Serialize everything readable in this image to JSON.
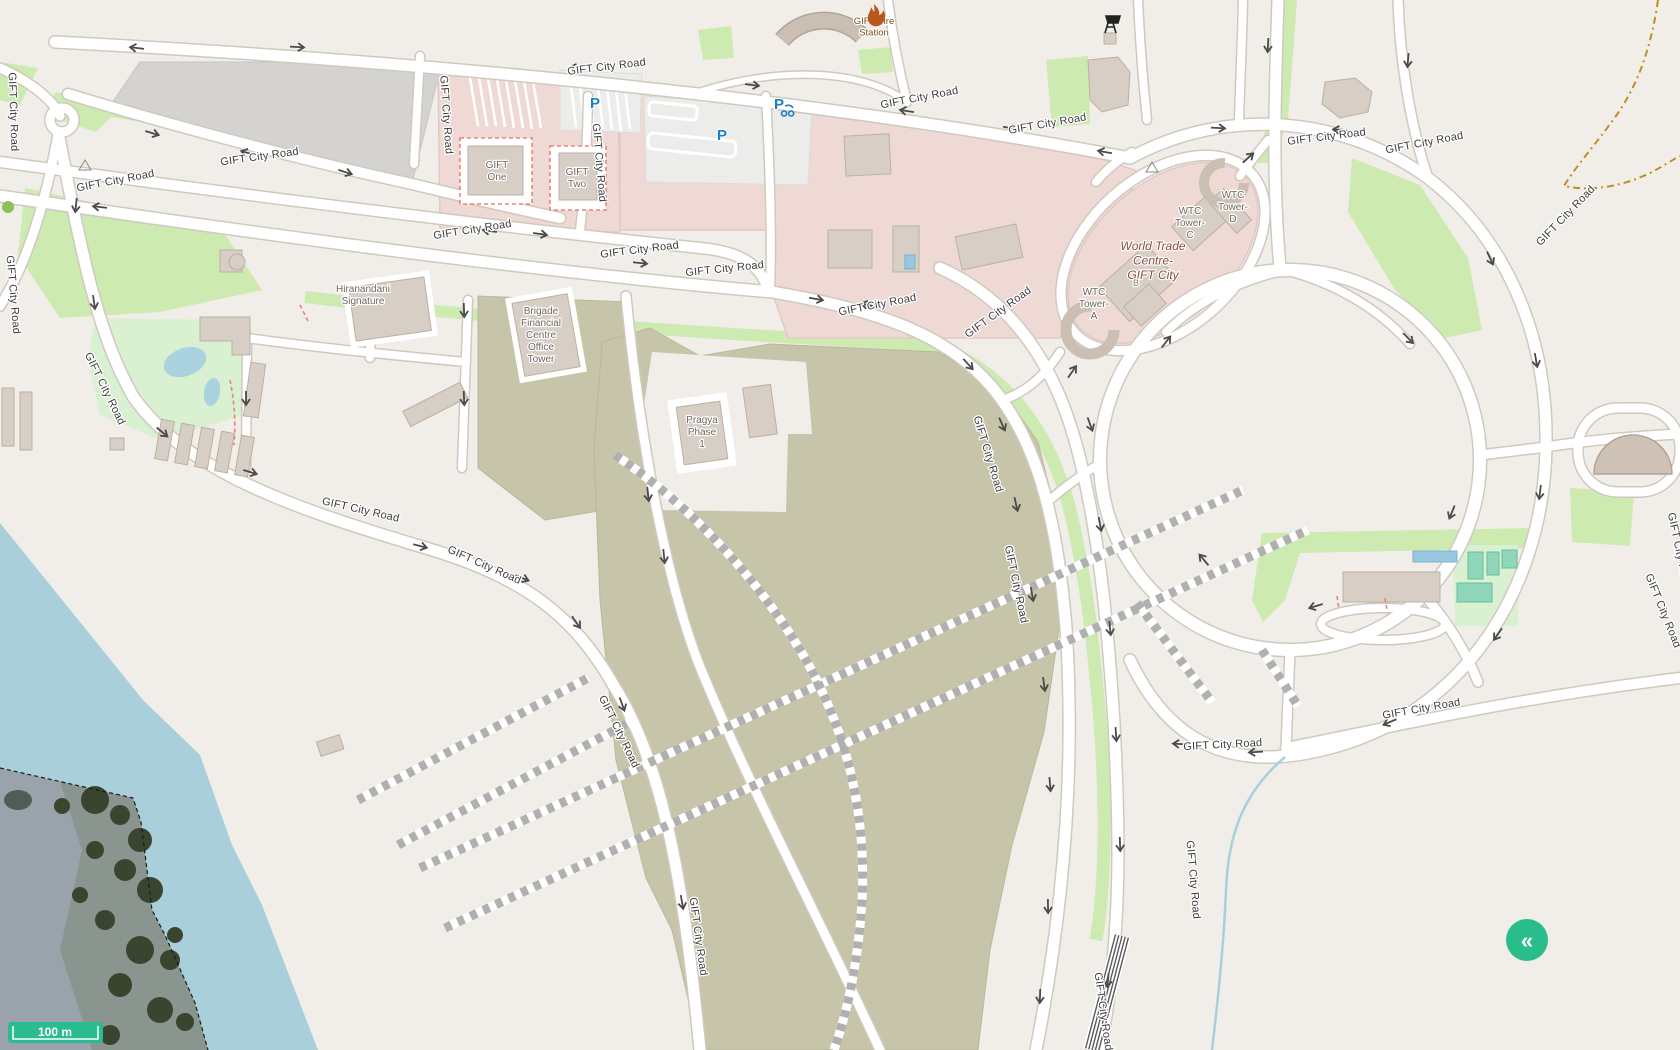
{
  "map": {
    "road_name": "GIFT City Road",
    "road_labels": [
      [
        607,
        70,
        -7
      ],
      [
        920,
        101,
        -11
      ],
      [
        1048,
        127,
        -10
      ],
      [
        260,
        160,
        -8
      ],
      [
        116,
        184,
        -11
      ],
      [
        10,
        112,
        88
      ],
      [
        10,
        295,
        85
      ],
      [
        443,
        115,
        86
      ],
      [
        596,
        163,
        85
      ],
      [
        473,
        233,
        -9
      ],
      [
        640,
        253,
        -7
      ],
      [
        725,
        272,
        -6
      ],
      [
        878,
        308,
        -11
      ],
      [
        1000,
        315,
        -36
      ],
      [
        102,
        390,
        64
      ],
      [
        360,
        513,
        13
      ],
      [
        483,
        568,
        24
      ],
      [
        616,
        733,
        64
      ],
      [
        695,
        937,
        82
      ],
      [
        1327,
        140,
        -7
      ],
      [
        1425,
        146,
        -11
      ],
      [
        1568,
        218,
        -46
      ],
      [
        985,
        455,
        73
      ],
      [
        1013,
        585,
        78
      ],
      [
        1190,
        880,
        85
      ],
      [
        1100,
        1012,
        82
      ],
      [
        1223,
        748,
        -3
      ],
      [
        1422,
        712,
        -10
      ],
      [
        1660,
        612,
        68
      ],
      [
        1676,
        552,
        78
      ]
    ],
    "arrows": [
      [
        137,
        48,
        187
      ],
      [
        297,
        47,
        3
      ],
      [
        577,
        68,
        188
      ],
      [
        752,
        85,
        7
      ],
      [
        907,
        111,
        189
      ],
      [
        1010,
        128,
        10
      ],
      [
        152,
        133,
        17
      ],
      [
        248,
        153,
        196
      ],
      [
        345,
        172,
        18
      ],
      [
        490,
        231,
        188
      ],
      [
        540,
        234,
        8
      ],
      [
        100,
        207,
        187
      ],
      [
        640,
        263,
        6
      ],
      [
        816,
        299,
        10
      ],
      [
        868,
        305,
        192
      ],
      [
        968,
        364,
        48
      ],
      [
        1002,
        424,
        66
      ],
      [
        1016,
        504,
        77
      ],
      [
        1032,
        594,
        80
      ],
      [
        1044,
        684,
        82
      ],
      [
        1050,
        784,
        85
      ],
      [
        1048,
        906,
        89
      ],
      [
        1040,
        996,
        92
      ],
      [
        1090,
        424,
        70
      ],
      [
        1100,
        524,
        80
      ],
      [
        1110,
        628,
        84
      ],
      [
        1116,
        734,
        86
      ],
      [
        1120,
        844,
        88
      ],
      [
        1108,
        980,
        95
      ],
      [
        76,
        205,
        96
      ],
      [
        94,
        302,
        82
      ],
      [
        162,
        432,
        40
      ],
      [
        250,
        472,
        17
      ],
      [
        420,
        546,
        14
      ],
      [
        522,
        578,
        22
      ],
      [
        576,
        622,
        55
      ],
      [
        622,
        704,
        70
      ],
      [
        682,
        902,
        80
      ],
      [
        464,
        310,
        88
      ],
      [
        464,
        398,
        88
      ],
      [
        246,
        398,
        90
      ],
      [
        648,
        494,
        84
      ],
      [
        664,
        556,
        84
      ],
      [
        1166,
        342,
        -52
      ],
      [
        1408,
        338,
        46
      ],
      [
        1452,
        512,
        112
      ],
      [
        1316,
        606,
        163
      ],
      [
        1204,
        560,
        -130
      ],
      [
        1218,
        128,
        3
      ],
      [
        1105,
        152,
        190
      ],
      [
        1340,
        130,
        185
      ],
      [
        1490,
        258,
        65
      ],
      [
        1536,
        360,
        80
      ],
      [
        1540,
        492,
        97
      ],
      [
        1498,
        634,
        125
      ],
      [
        1390,
        722,
        157
      ],
      [
        1256,
        752,
        177
      ],
      [
        1180,
        744,
        183
      ],
      [
        1072,
        372,
        -55
      ],
      [
        1248,
        158,
        -42
      ],
      [
        1268,
        45,
        93
      ],
      [
        1408,
        60,
        95
      ]
    ],
    "places": [
      {
        "id": "gift-fire-station",
        "lines": [
          "GIFT Fire",
          "Station"
        ],
        "x": 874,
        "y": 24,
        "color": "#7a4f16",
        "size": 9.5,
        "italic": false
      },
      {
        "id": "world-trade-centre-gift-city",
        "lines": [
          "World Trade",
          "Centre-",
          "GIFT City"
        ],
        "x": 1153,
        "y": 250,
        "color": "#8d4a42",
        "size": 12,
        "italic": true
      },
      {
        "id": "gift-one",
        "lines": [
          "GIFT",
          "One"
        ],
        "x": 497,
        "y": 168,
        "color": "#6f675f",
        "size": 10,
        "italic": false
      },
      {
        "id": "gift-two",
        "lines": [
          "GIFT",
          "Two"
        ],
        "x": 577,
        "y": 175,
        "color": "#6f675f",
        "size": 10,
        "italic": false
      },
      {
        "id": "hiranandani-signature",
        "lines": [
          "Hiranandani",
          "Signature"
        ],
        "x": 363,
        "y": 292,
        "color": "#6f675f",
        "size": 10,
        "italic": false
      },
      {
        "id": "brigade-financial-centre-office-tower",
        "lines": [
          "Brigade",
          "Financial",
          "Centre",
          "Office",
          "Tower"
        ],
        "x": 541,
        "y": 314,
        "color": "#6f675f",
        "size": 10,
        "italic": false
      },
      {
        "id": "pragya-phase-1",
        "lines": [
          "Pragya",
          "Phase",
          "1"
        ],
        "x": 702,
        "y": 423,
        "color": "#6f675f",
        "size": 10,
        "italic": false
      },
      {
        "id": "wtc-tower-a",
        "lines": [
          "WTC",
          "Tower-",
          "A"
        ],
        "x": 1094,
        "y": 295,
        "color": "#6f675f",
        "size": 10,
        "italic": false
      },
      {
        "id": "wtc-tower-b",
        "lines": [
          "B"
        ],
        "x": 1136,
        "y": 286,
        "color": "#8a8178",
        "size": 9,
        "italic": false
      },
      {
        "id": "wtc-tower-c",
        "lines": [
          "WTC",
          "Tower-",
          "C"
        ],
        "x": 1190,
        "y": 214,
        "color": "#6f675f",
        "size": 10,
        "italic": false
      },
      {
        "id": "wtc-tower-d",
        "lines": [
          "WTC",
          "Tower-",
          "D"
        ],
        "x": 1233,
        "y": 198,
        "color": "#6f675f",
        "size": 10,
        "italic": false
      }
    ],
    "parking_icons": [
      {
        "x": 595,
        "y": 103,
        "type": "car"
      },
      {
        "x": 722,
        "y": 135,
        "type": "car"
      },
      {
        "x": 779,
        "y": 104,
        "type": "moped"
      }
    ],
    "scale_bar": {
      "label": "100 m"
    },
    "collapse_button": {
      "glyph": "«"
    },
    "colors": {
      "land": "#f1eee9",
      "water": "#a9cfdb",
      "green": "#cdeab0",
      "garden": "#d9f1d1",
      "pink": "#eed9d5",
      "pink_edge": "#e2c9c5",
      "industrial": "#d4d3d1",
      "olive": "#c7c5a9",
      "building": "#d7cec5",
      "building_edge": "#bdb0a1",
      "road_casing": "#cfc9bf",
      "construction_dash": "#b0b0b0",
      "pitch": "#8fd6bb",
      "pool": "#99c6e0",
      "scalebar": "#2bbb90",
      "fab": "#2abd8c",
      "road_label": "#3c3c3c",
      "arrow": "#4a4a4a",
      "parking": "#1a7fc4",
      "red_dash": "#e8837a",
      "stream": "#a8cfda",
      "track": "#bf8e25",
      "fire_label": "#7a4f16",
      "wtc_label": "#8d4a42",
      "building_label": "#6f675f"
    }
  }
}
